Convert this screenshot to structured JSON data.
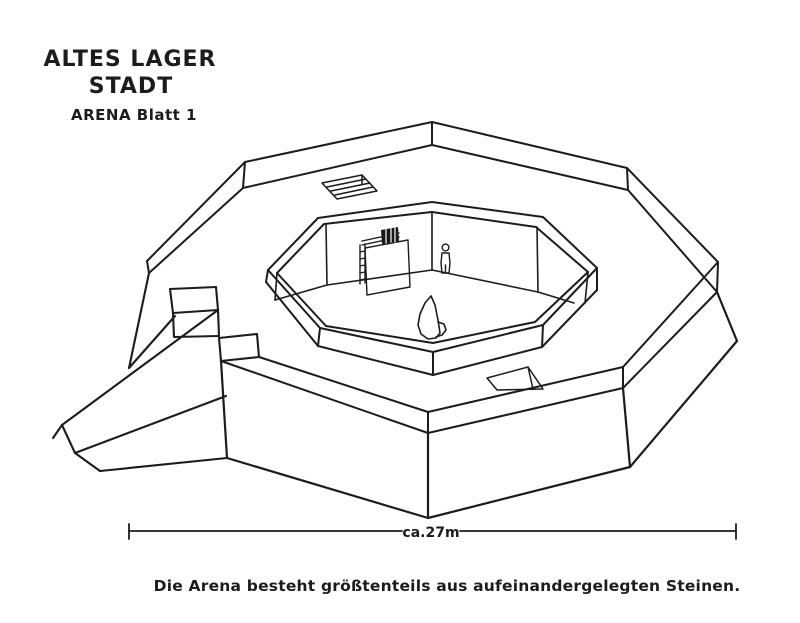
{
  "title": {
    "line1": "ALTES LAGER",
    "line2": "STADT",
    "line3": "ARENA Blatt 1"
  },
  "caption": "Die Arena besteht größtenteils aus aufeinandergelegten Steinen.",
  "scale_bar": {
    "label": "ca.27m"
  },
  "drawing": {
    "ink": "#1c1c1c",
    "background": "#ffffff",
    "groups": [
      {
        "name": "outer-wall-rim",
        "w": 2.0,
        "strokes": [
          [
            [
              259,
              357
            ],
            [
              428,
              412
            ],
            [
              623,
              367
            ],
            [
              718,
              262
            ],
            [
              627,
              168
            ],
            [
              432,
              122
            ],
            [
              245,
              162
            ],
            [
              147,
              261
            ]
          ],
          [
            [
              149,
              273
            ],
            [
              243,
              188
            ],
            [
              432,
              145
            ],
            [
              628,
              190
            ],
            [
              717,
              292
            ],
            [
              623,
              388
            ],
            [
              428,
              433
            ],
            [
              221,
              361
            ]
          ],
          [
            [
              432,
              122
            ],
            [
              432,
              145
            ]
          ],
          [
            [
              245,
              162
            ],
            [
              243,
              188
            ]
          ],
          [
            [
              627,
              168
            ],
            [
              628,
              190
            ]
          ],
          [
            [
              147,
              261
            ],
            [
              149,
              273
            ]
          ],
          [
            [
              718,
              262
            ],
            [
              717,
              292
            ]
          ],
          [
            [
              623,
              367
            ],
            [
              623,
              388
            ]
          ],
          [
            [
              428,
              412
            ],
            [
              428,
              433
            ]
          ]
        ]
      },
      {
        "name": "base-wall",
        "w": 2.2,
        "strokes": [
          [
            [
              717,
              292
            ],
            [
              737,
              341
            ]
          ],
          [
            [
              737,
              341
            ],
            [
              630,
              467
            ],
            [
              428,
              518
            ],
            [
              227,
              458
            ]
          ],
          [
            [
              623,
              388
            ],
            [
              630,
              467
            ]
          ],
          [
            [
              428,
              433
            ],
            [
              428,
              518
            ]
          ],
          [
            [
              221,
              361
            ],
            [
              227,
              458
            ]
          ]
        ]
      },
      {
        "name": "entrance-ramp",
        "w": 2.1,
        "strokes": [
          [
            [
              149,
              273
            ],
            [
              129,
              368
            ]
          ],
          [
            [
              129,
              368
            ],
            [
              175,
              316
            ]
          ],
          [
            [
              170,
              289
            ],
            [
              216,
              287
            ],
            [
              218,
              310
            ],
            [
              173,
              313
            ],
            [
              170,
              289
            ]
          ],
          [
            [
              173,
              313
            ],
            [
              174,
              337
            ],
            [
              219,
              336
            ]
          ],
          [
            [
              218,
              310
            ],
            [
              219,
              336
            ]
          ],
          [
            [
              219,
              338
            ],
            [
              257,
              334
            ],
            [
              259,
              357
            ],
            [
              221,
              361
            ],
            [
              219,
              338
            ]
          ],
          [
            [
              218,
              310
            ],
            [
              62,
              425
            ]
          ],
          [
            [
              226,
              396
            ],
            [
              75,
              453
            ]
          ],
          [
            [
              62,
              425
            ],
            [
              75,
              453
            ]
          ],
          [
            [
              62,
              425
            ],
            [
              53,
              438
            ]
          ],
          [
            [
              75,
              453
            ],
            [
              100,
              471
            ]
          ],
          [
            [
              100,
              471
            ],
            [
              227,
              458
            ]
          ]
        ]
      },
      {
        "name": "stair-opening-top",
        "w": 1.5,
        "strokes": [
          [
            [
              322,
              183
            ],
            [
              362,
              175
            ],
            [
              377,
              191
            ],
            [
              337,
              199
            ],
            [
              322,
              183
            ]
          ],
          [
            [
              362,
              175
            ],
            [
              362,
              184
            ]
          ],
          [
            [
              327,
              187
            ],
            [
              366,
              179
            ]
          ],
          [
            [
              331,
              191
            ],
            [
              370,
              183
            ]
          ],
          [
            [
              335,
              195
            ],
            [
              373,
              187
            ]
          ]
        ]
      },
      {
        "name": "stair-opening-front",
        "w": 1.5,
        "strokes": [
          [
            [
              487,
              378
            ],
            [
              528,
              367
            ],
            [
              543,
              389
            ],
            [
              497,
              390
            ],
            [
              487,
              378
            ]
          ],
          [
            [
              528,
              367
            ],
            [
              533,
              389
            ]
          ]
        ]
      },
      {
        "name": "inner-wall-rim",
        "w": 2.0,
        "strokes": [
          [
            [
              268,
              270
            ],
            [
              318,
              218
            ],
            [
              432,
              202
            ],
            [
              543,
              217
            ],
            [
              597,
              268
            ],
            [
              543,
              325
            ],
            [
              433,
              352
            ],
            [
              320,
              328
            ],
            [
              268,
              270
            ]
          ],
          [
            [
              277,
              273
            ],
            [
              324,
              224
            ],
            [
              432,
              212
            ],
            [
              536,
              227
            ],
            [
              588,
              272
            ],
            [
              535,
              322
            ],
            [
              433,
              343
            ],
            [
              326,
              326
            ],
            [
              277,
              273
            ]
          ],
          [
            [
              266,
              282
            ],
            [
              318,
              346
            ],
            [
              433,
              375
            ],
            [
              542,
              347
            ],
            [
              597,
              290
            ]
          ],
          [
            [
              268,
              270
            ],
            [
              266,
              282
            ]
          ],
          [
            [
              320,
              328
            ],
            [
              318,
              346
            ]
          ],
          [
            [
              433,
              352
            ],
            [
              433,
              375
            ]
          ],
          [
            [
              543,
              325
            ],
            [
              542,
              347
            ]
          ],
          [
            [
              597,
              268
            ],
            [
              597,
              290
            ]
          ]
        ]
      },
      {
        "name": "arena-interior",
        "w": 1.6,
        "strokes": [
          [
            [
              326,
              224
            ],
            [
              327,
              285
            ]
          ],
          [
            [
              432,
              212
            ],
            [
              432,
              270
            ]
          ],
          [
            [
              537,
              227
            ],
            [
              538,
              292
            ]
          ],
          [
            [
              277,
              273
            ],
            [
              275,
              300
            ]
          ],
          [
            [
              275,
              300
            ],
            [
              327,
              285
            ],
            [
              432,
              270
            ],
            [
              538,
              292
            ]
          ],
          [
            [
              538,
              292
            ],
            [
              574,
              303
            ]
          ],
          [
            [
              588,
              272
            ],
            [
              585,
              303
            ]
          ]
        ]
      },
      {
        "name": "door-and-ladder",
        "w": 1.4,
        "strokes": [
          [
            [
              360,
              245
            ],
            [
              360,
              284
            ]
          ],
          [
            [
              365,
              244
            ],
            [
              365,
              283
            ]
          ],
          [
            [
              360,
              252
            ],
            [
              365,
              251
            ]
          ],
          [
            [
              360,
              259
            ],
            [
              365,
              258
            ]
          ],
          [
            [
              360,
              266
            ],
            [
              365,
              265
            ]
          ],
          [
            [
              360,
              273
            ],
            [
              365,
              272
            ]
          ],
          [
            [
              360,
              280
            ],
            [
              365,
              279
            ]
          ],
          [
            [
              362,
              241
            ],
            [
              399,
              233
            ]
          ],
          [
            [
              362,
              245
            ],
            [
              399,
              237
            ]
          ],
          [
            [
              365,
              248
            ],
            [
              408,
              240
            ],
            [
              410,
              287
            ],
            [
              367,
              295
            ],
            [
              365,
              248
            ]
          ]
        ],
        "fills": [
          {
            "pts": [
              [
                381,
                230
              ],
              [
                398,
                227
              ],
              [
                399,
                241
              ],
              [
                382,
                244
              ]
            ],
            "color": "#161616"
          }
        ]
      },
      {
        "name": "door-sign-hatch",
        "w": 1.2,
        "color": "#ffffff",
        "strokes": [
          [
            [
              386,
              229
            ],
            [
              386,
              243
            ]
          ],
          [
            [
              391,
              228
            ],
            [
              391,
              242
            ]
          ],
          [
            [
              395,
              228
            ],
            [
              395,
              242
            ]
          ]
        ]
      },
      {
        "name": "human-figure",
        "w": 1.4,
        "strokes": [
          [
            [
              442,
              253
            ],
            [
              449,
              253
            ],
            [
              450,
              263
            ],
            [
              449,
              273
            ],
            [
              442,
              273
            ],
            [
              441,
              263
            ],
            [
              442,
              253
            ]
          ],
          [
            [
              445.5,
              265
            ],
            [
              445.5,
              273
            ]
          ]
        ],
        "circles": [
          [
            445.5,
            247.5,
            3.4
          ]
        ]
      },
      {
        "name": "standing-stone",
        "w": 1.6,
        "strokes": [
          [
            [
              431,
              296
            ],
            [
              425,
              303
            ],
            [
              420,
              314
            ],
            [
              418,
              325
            ],
            [
              421,
              334
            ],
            [
              428,
              339
            ],
            [
              436,
              338
            ],
            [
              440,
              333
            ],
            [
              438,
              320
            ],
            [
              435,
              305
            ],
            [
              431,
              296
            ]
          ],
          [
            [
              438,
              322
            ],
            [
              444,
              324
            ],
            [
              446,
              330
            ],
            [
              442,
              335
            ],
            [
              436,
              337
            ]
          ]
        ]
      },
      {
        "name": "scale-bar-lines",
        "w": 1.8,
        "strokes": [
          [
            [
              129,
              531
            ],
            [
              402,
              531
            ]
          ],
          [
            [
              460,
              531
            ],
            [
              736,
              531
            ]
          ],
          [
            [
              129,
              524
            ],
            [
              129,
              539
            ]
          ],
          [
            [
              736,
              524
            ],
            [
              736,
              539
            ]
          ]
        ]
      }
    ]
  }
}
